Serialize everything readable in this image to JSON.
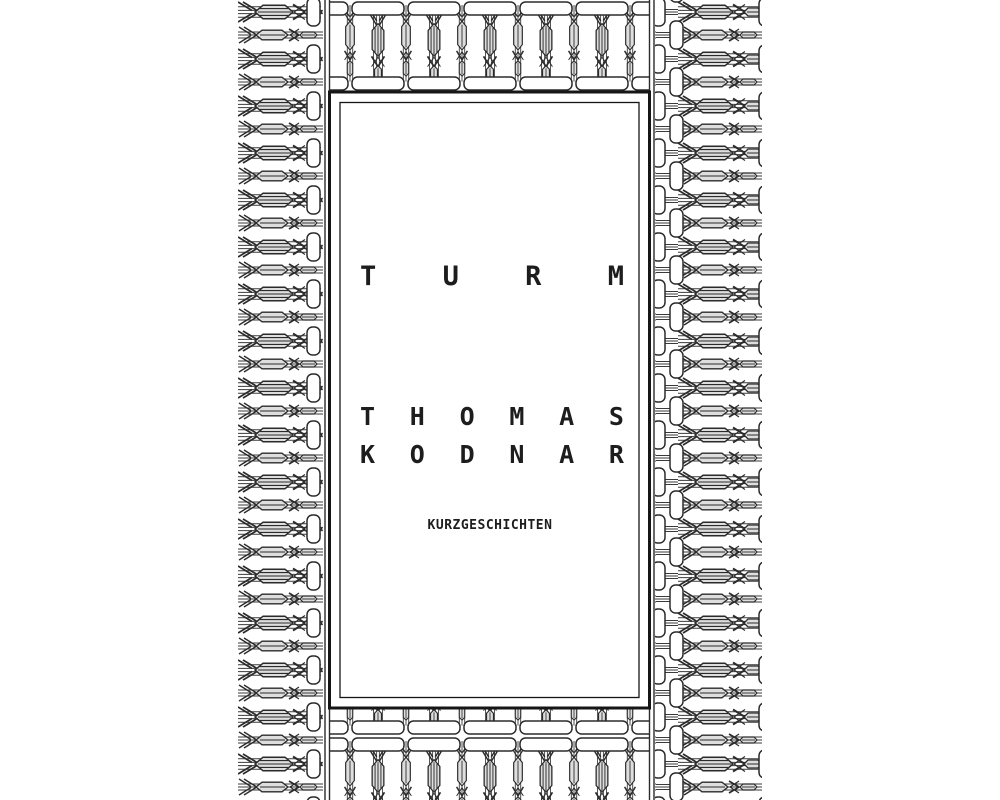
{
  "cover": {
    "type": "book-cover",
    "title": {
      "text": "TURM",
      "letters": [
        "T",
        "U",
        "R",
        "M"
      ]
    },
    "author": {
      "full_name": "THOMAS KODNAR",
      "line1": {
        "text": "THOMAS",
        "letters": [
          "T",
          "H",
          "O",
          "M",
          "A",
          "S"
        ]
      },
      "line2": {
        "text": "KODNAR",
        "letters": [
          "K",
          "O",
          "D",
          "N",
          "A",
          "R"
        ]
      }
    },
    "subtitle": "KURZGESCHICHTEN",
    "ornament": {
      "description": "repeating arrow-machinery border pattern",
      "icon_names": [
        "arrow-right-motif-icon",
        "arrow-down-motif-icon",
        "capsule-socket-icon"
      ]
    },
    "colors": {
      "background": "#ffffff",
      "ink": "#2b2b2b",
      "panel_border": "#161616",
      "motif_body_fill": "#dedede",
      "text": "#1d1d1d"
    }
  }
}
